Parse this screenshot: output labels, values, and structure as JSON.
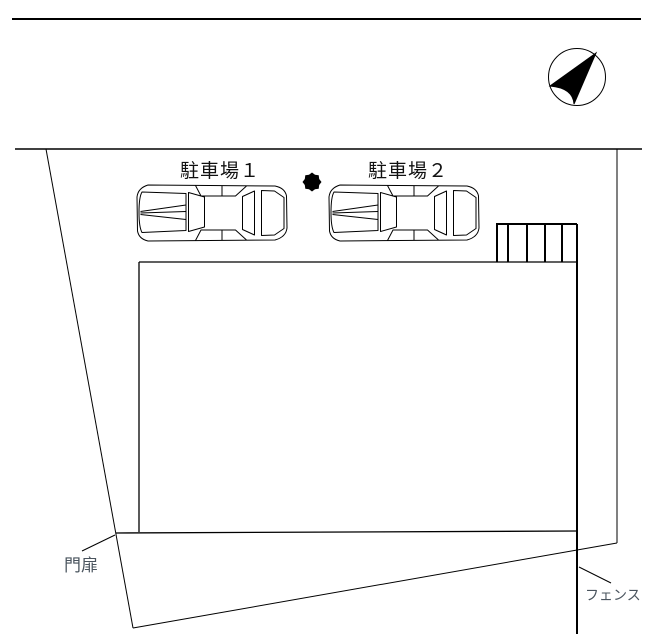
{
  "page": {
    "background": "#ffffff",
    "line_color": "#000000",
    "text_color": "#111111",
    "annotation_text_color": "#4a545e"
  },
  "drawing": {
    "labels": {
      "parking_1": "駐車場１",
      "parking_2": "駐車場２",
      "gate": "門扉",
      "fence": "フェンス"
    },
    "icons": {
      "north_arrow": "compass-north-arrow-icon",
      "tree": "tree-icon",
      "car_1": "car-top-view",
      "car_2": "car-top-view"
    }
  }
}
